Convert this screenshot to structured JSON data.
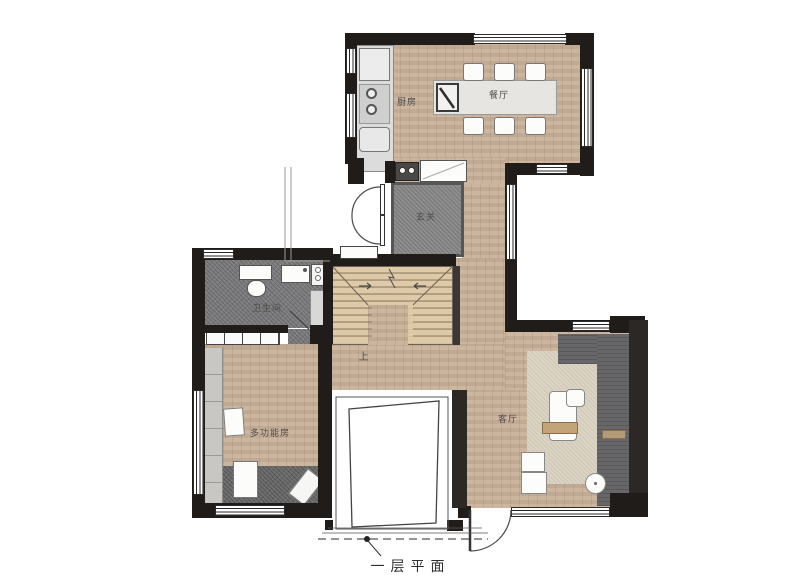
{
  "plan": {
    "caption": "一层平面",
    "rooms": {
      "kitchen": "厨房",
      "dining": "餐厅",
      "entry": "玄关",
      "bath": "卫生间",
      "multi": "多功能房",
      "living": "客厅"
    },
    "stairs": {
      "up": "上"
    },
    "colors": {
      "wall": "#1f1c1a",
      "wood_floor": "#c9b199",
      "stair_wood": "#decaa9",
      "tile_gray": "#7d7d7f",
      "entry_mat": "#8f8f8f",
      "rug_beige": "#ddd5c4",
      "rug_dark": "#6c6c6c",
      "sofa": "#67676a"
    }
  }
}
